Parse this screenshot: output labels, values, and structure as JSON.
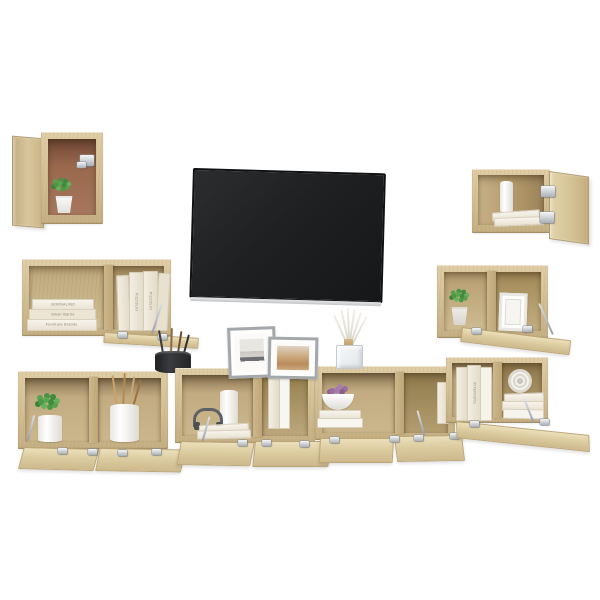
{
  "scene": {
    "title": "8-piece TV wall cabinet set, Sonoma oak, product photo on white",
    "background_color": "#ffffff"
  },
  "palette": {
    "oak_light": "#e3d4ae",
    "oak": "#d3bf94",
    "oak_shadow": "#b49b6f",
    "interior_brown": "#9c6a4e",
    "tv_black": "#1d1e20",
    "tv_strip": "#d6d8d9",
    "metal": "#aab1b7",
    "plant_green": "#4c9845",
    "succulent_purple": "#9a6f9e"
  },
  "tv": {
    "name": "wall-mounted flat-screen TV, blank screen"
  },
  "decor": {
    "book_titles": [
      "BORSALINO",
      "Silver Barrie",
      "Furniture Brands"
    ],
    "spine_title_1": "PIZZOLIO",
    "spine_title_2": "PIZZOLIO",
    "spine_title_right": "INTERIORS",
    "items": [
      "green potted plant",
      "succulent in pot",
      "stacked decor books",
      "two picture frames",
      "reed diffuser",
      "utensil cup with brushes",
      "headphones",
      "paper roll",
      "black jar with stir sticks",
      "bowl of purple succulents",
      "rope coil"
    ]
  },
  "units": [
    {
      "id": "top-left-wall-cube",
      "state": "door open left"
    },
    {
      "id": "top-right-wall-cabinet",
      "state": "door open right"
    },
    {
      "id": "left-wall-shelf",
      "state": "flap door open"
    },
    {
      "id": "right-wall-shelf",
      "state": "flap door open"
    },
    {
      "id": "bottom-left-cabinet",
      "state": "two flap doors open"
    },
    {
      "id": "center-tv-stand-left",
      "state": "two flap doors open"
    },
    {
      "id": "center-tv-stand-right",
      "state": "two flap doors open"
    },
    {
      "id": "bottom-right-cabinet",
      "state": "flap door open"
    }
  ]
}
